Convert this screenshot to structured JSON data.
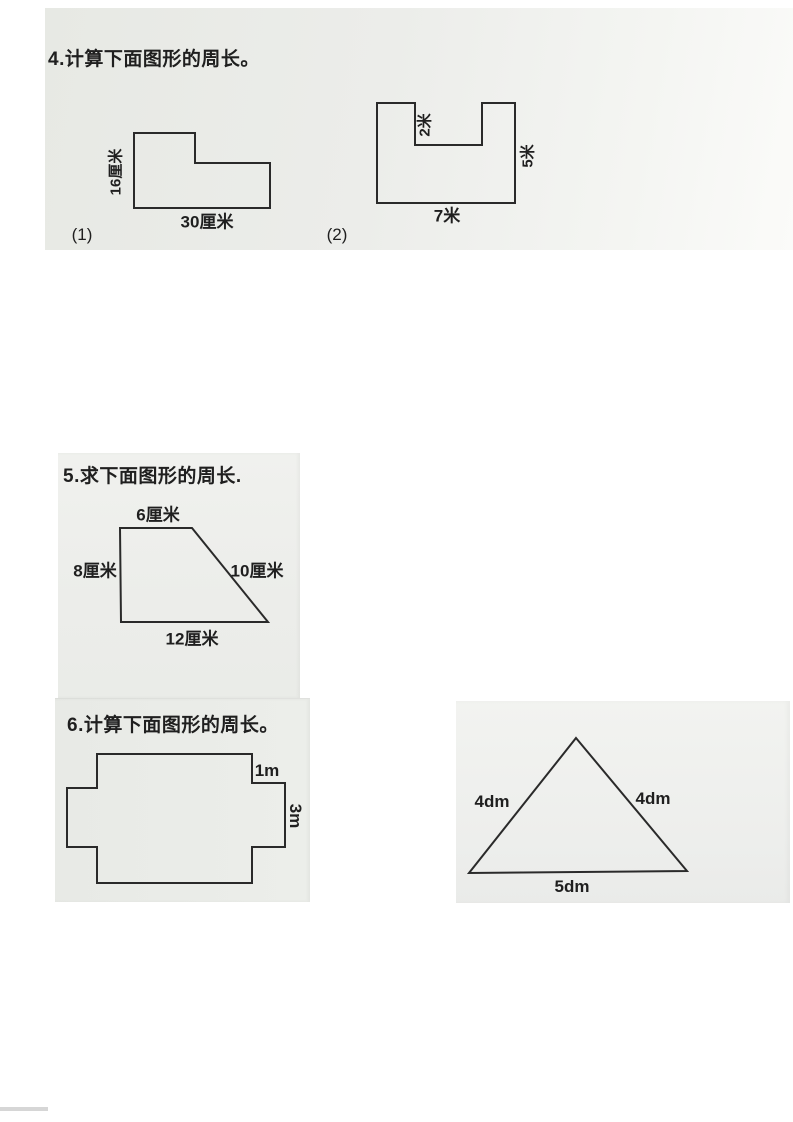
{
  "colors": {
    "ink": "#2a2a2a",
    "scan_paper_top": "#eaebe6",
    "scan_paper_mid": "#edeeea",
    "scan_paper_bottom": "#e9ebe7",
    "scan_paper_triangle": "#f0f1ee"
  },
  "problem4": {
    "title": "4.计算下面图形的周长。",
    "figure1": {
      "caption": "(1)",
      "side_left": "16厘米",
      "side_bottom": "30厘米"
    },
    "figure2": {
      "caption": "(2)",
      "notch_depth": "2米",
      "side_right": "5米",
      "side_bottom": "7米"
    }
  },
  "problem5": {
    "title": "5.求下面图形的周长.",
    "trapezoid": {
      "side_top": "6厘米",
      "side_left": "8厘米",
      "side_right": "10厘米",
      "side_bottom": "12厘米"
    }
  },
  "problem6": {
    "title": "6.计算下面图形的周长。",
    "cross": {
      "step_right": "1m",
      "side_right": "3m"
    },
    "triangle": {
      "side_left": "4dm",
      "side_right": "4dm",
      "side_bottom": "5dm"
    }
  }
}
